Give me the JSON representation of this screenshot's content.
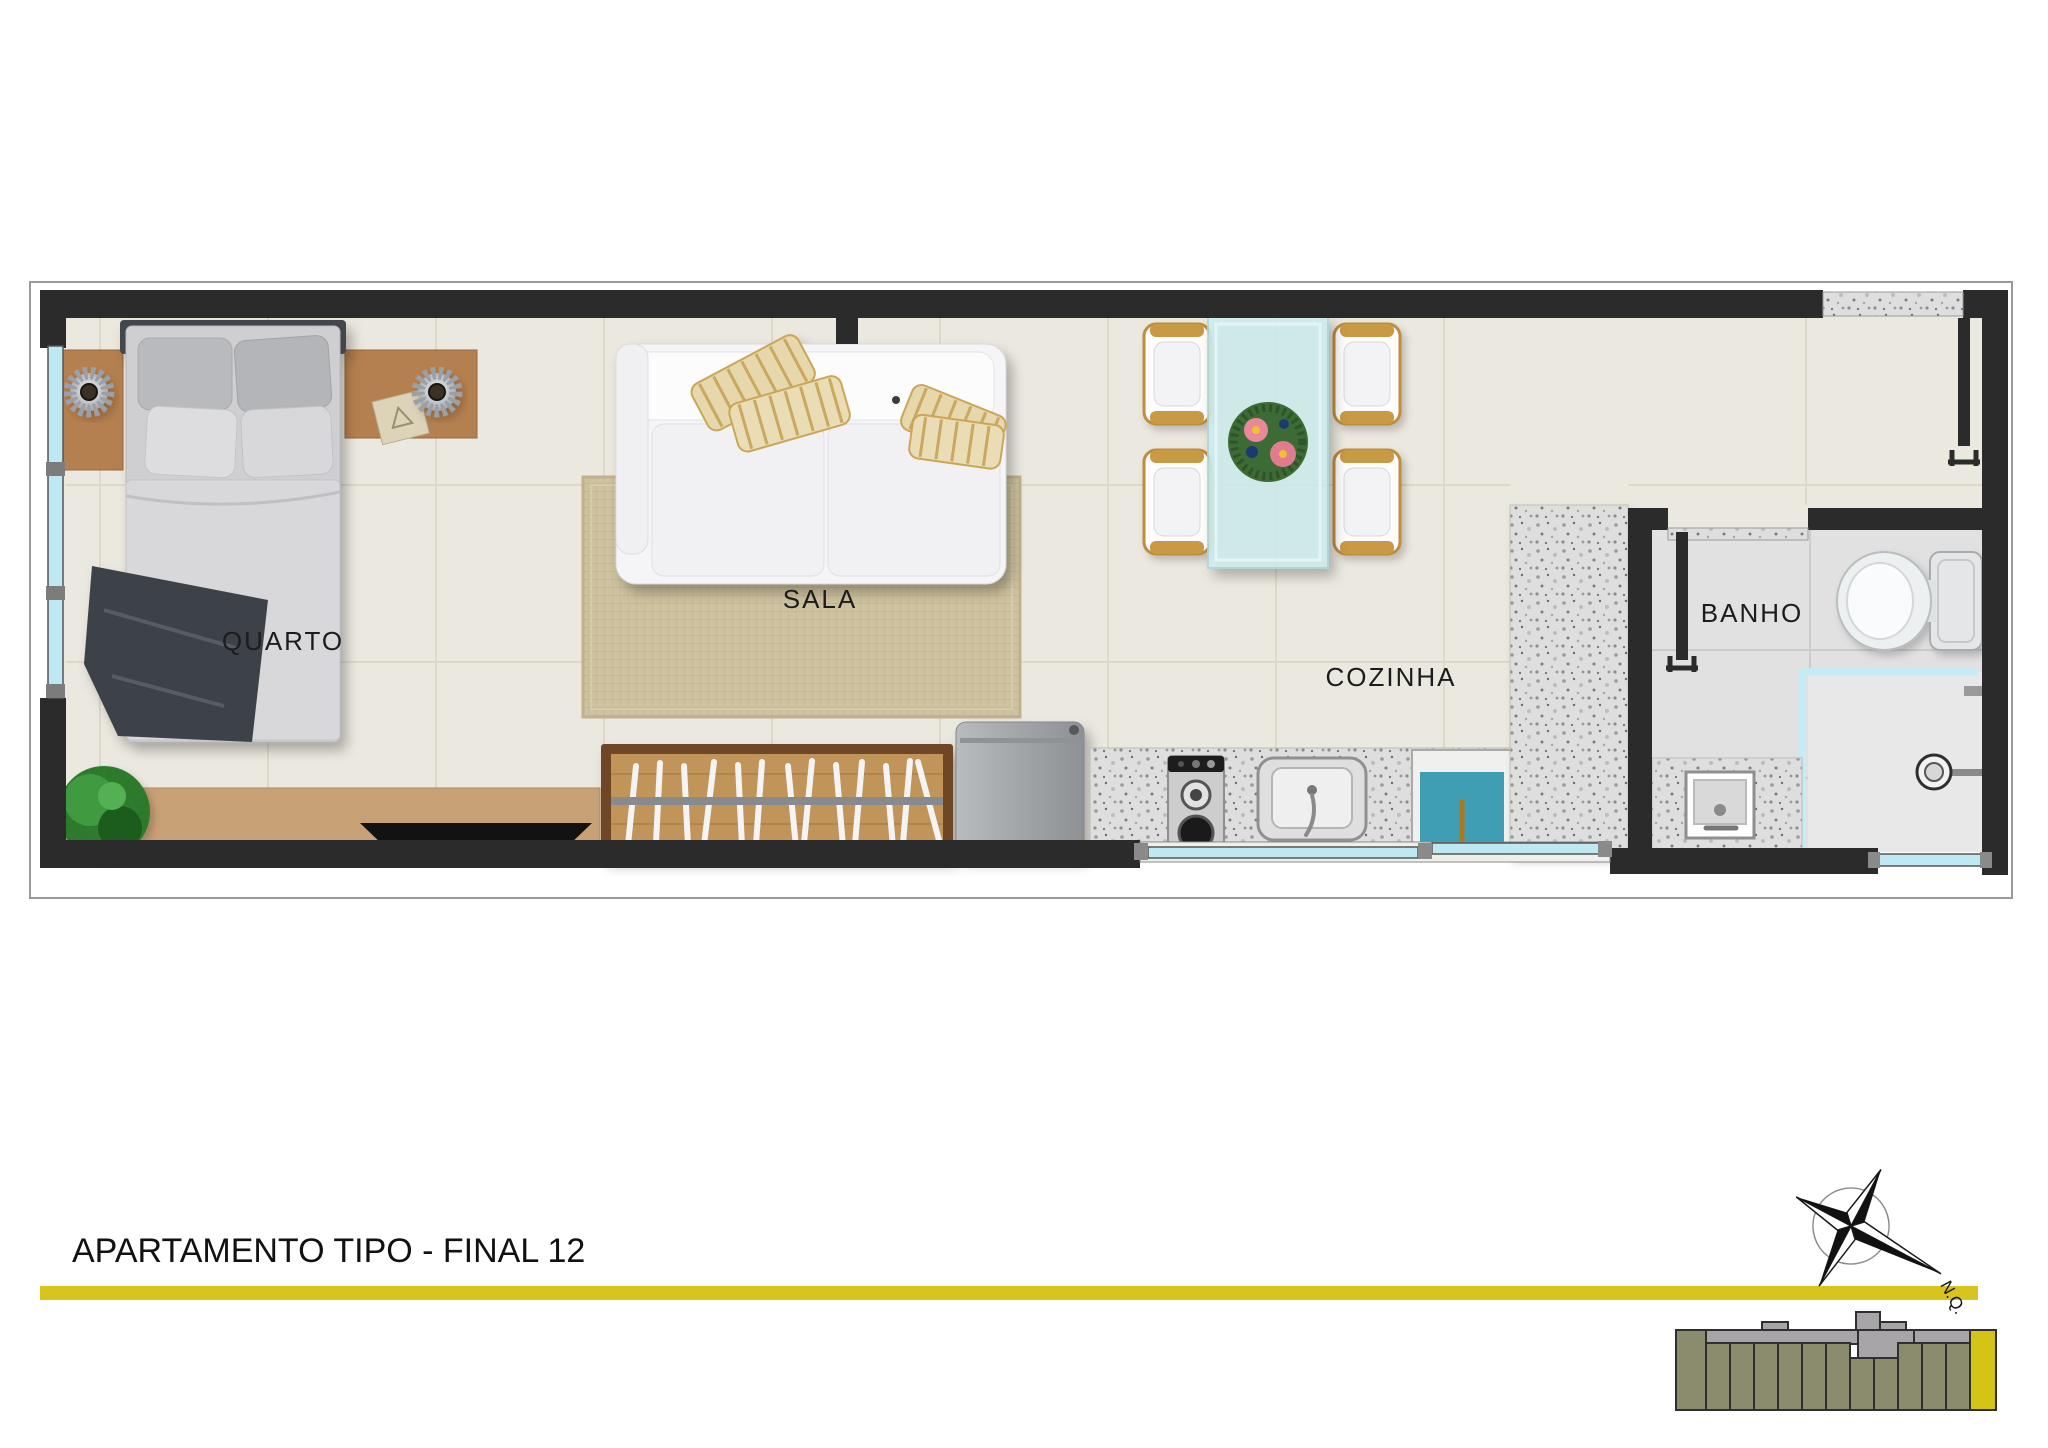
{
  "title_block": {
    "title": "APARTAMENTO TIPO - FINAL 12"
  },
  "rooms": {
    "quarto": {
      "label": "QUARTO"
    },
    "sala": {
      "label": "SALA"
    },
    "cozinha": {
      "label": "COZINHA"
    },
    "banho": {
      "label": "BANHO"
    }
  },
  "compass": {
    "label": "N.Q."
  },
  "colors": {
    "wall": "#2b2b2b",
    "floor": "#ebe8df",
    "floor_grid": "#dcd8cc",
    "bath_floor": "#e1e1e1",
    "rug": "#cec2a0",
    "wood_frame": "#6f4626",
    "wood": "#c1945a",
    "nightstand_wood": "#b5804f",
    "sideboard_wood": "#c9a177",
    "glass_table": "#cfedee",
    "window_glass": "#bfe9f2",
    "tank_water": "#3f9db4",
    "granite": "#dedede",
    "divider_yellow": "#d8c41c",
    "keyplan_unit_olive": "#8b8b6e",
    "keyplan_corridor_gray": "#a8a5a8",
    "keyplan_highlight_yellow": "#d4c415"
  },
  "icons": [
    "double-bed",
    "nightstand",
    "table-lamp",
    "plant",
    "tv-sideboard",
    "tv",
    "slat-rack",
    "sofa",
    "throw-pillow",
    "rug",
    "dining-table",
    "dining-chair",
    "flower-centerpiece",
    "fridge",
    "stove-cooktop",
    "kitchen-sink",
    "laundry-tank",
    "granite-counter",
    "toilet",
    "shower-head",
    "bathroom-sink",
    "window",
    "entry-door",
    "bathroom-door",
    "compass-rose",
    "building-key-plan"
  ]
}
